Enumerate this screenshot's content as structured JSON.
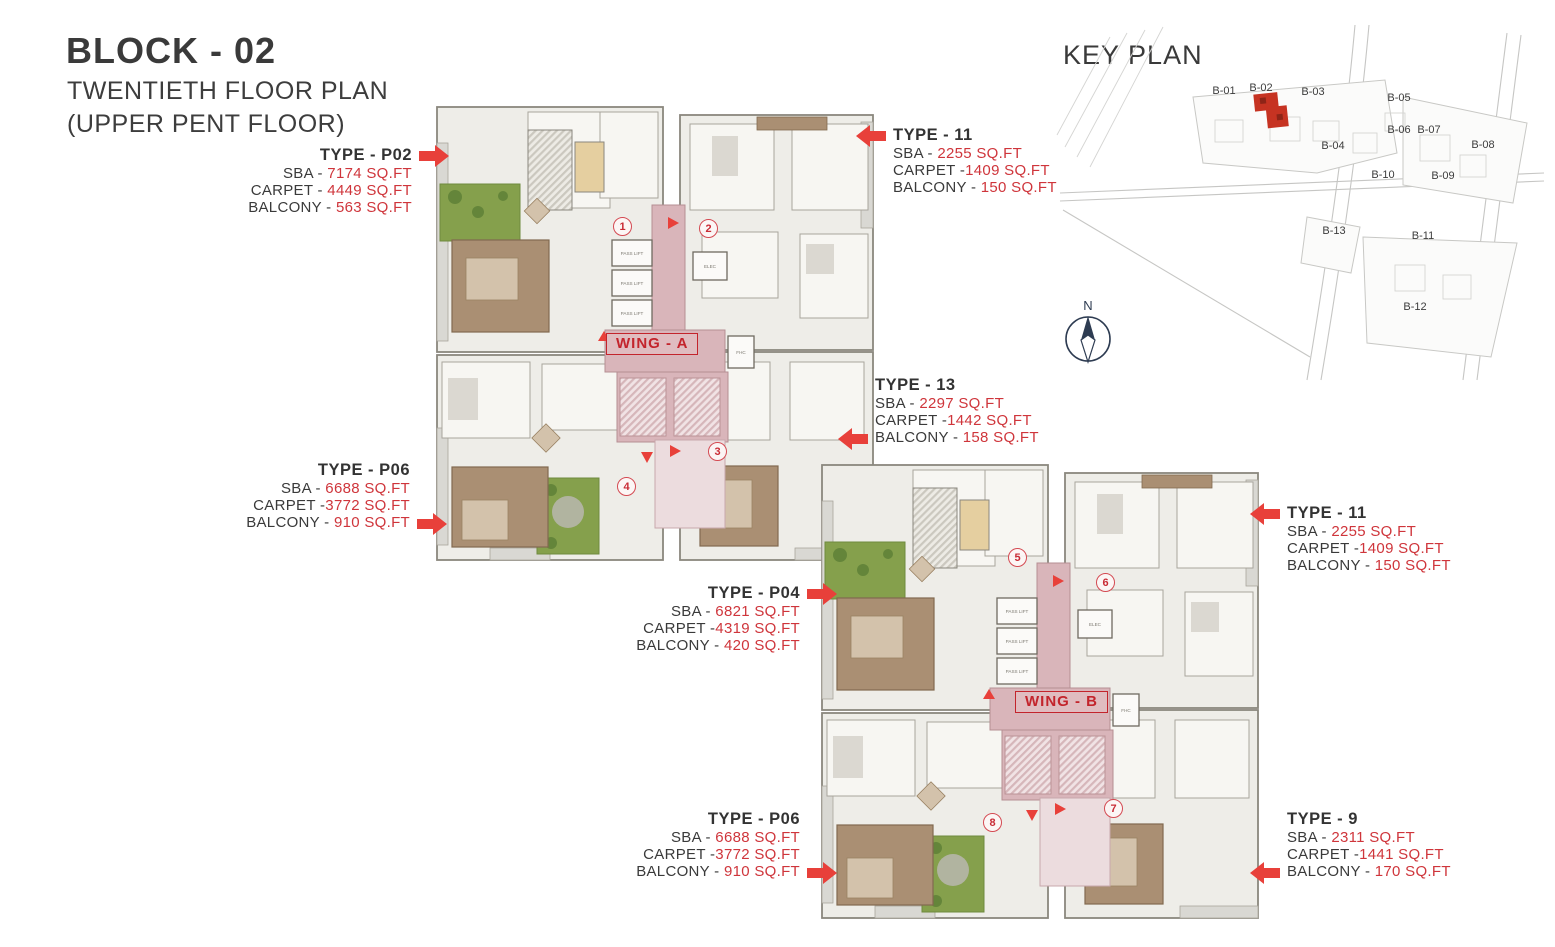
{
  "header": {
    "title": "BLOCK - 02",
    "subtitle_line1": "TWENTIETH FLOOR PLAN",
    "subtitle_line2": "(UPPER PENT FLOOR)"
  },
  "key_plan": {
    "title": "KEY PLAN",
    "compass_label": "N",
    "highlighted_block": "B-02",
    "blocks": [
      "B-01",
      "B-02",
      "B-03",
      "B-04",
      "B-05",
      "B-06",
      "B-07",
      "B-08",
      "B-09",
      "B-10",
      "B-11",
      "B-12",
      "B-13"
    ]
  },
  "wings": {
    "wing_a": "WING - A",
    "wing_b": "WING - B"
  },
  "plan_labels": {
    "pass_lift": "PASS LIFT",
    "elec": "ELEC",
    "fhc": "FHC"
  },
  "unit_markers": [
    "1",
    "2",
    "3",
    "4",
    "5",
    "6",
    "7",
    "8"
  ],
  "type_labels": [
    {
      "name": "TYPE - P02",
      "sba_l": "SBA - ",
      "sba_v": "7174 SQ.FT",
      "carpet_l": "CARPET - ",
      "carpet_v": "4449 SQ.FT",
      "balcony_l": "BALCONY - ",
      "balcony_v": "563 SQ.FT"
    },
    {
      "name": "TYPE - 11",
      "sba_l": "SBA - ",
      "sba_v": "2255 SQ.FT",
      "carpet_l": "CARPET -",
      "carpet_v": "1409 SQ.FT",
      "balcony_l": "BALCONY - ",
      "balcony_v": "150 SQ.FT"
    },
    {
      "name": "TYPE - 13",
      "sba_l": "SBA - ",
      "sba_v": "2297 SQ.FT",
      "carpet_l": "CARPET -",
      "carpet_v": "1442 SQ.FT",
      "balcony_l": "BALCONY - ",
      "balcony_v": "158 SQ.FT"
    },
    {
      "name": "TYPE - P06",
      "sba_l": "SBA - ",
      "sba_v": "6688 SQ.FT",
      "carpet_l": "CARPET -",
      "carpet_v": "3772 SQ.FT",
      "balcony_l": "BALCONY - ",
      "balcony_v": "910 SQ.FT"
    },
    {
      "name": "TYPE - P04",
      "sba_l": "SBA - ",
      "sba_v": "6821 SQ.FT",
      "carpet_l": "CARPET -",
      "carpet_v": "4319 SQ.FT",
      "balcony_l": "BALCONY - ",
      "balcony_v": "420 SQ.FT"
    },
    {
      "name": "TYPE - 11",
      "sba_l": "SBA - ",
      "sba_v": "2255 SQ.FT",
      "carpet_l": "CARPET -",
      "carpet_v": "1409 SQ.FT",
      "balcony_l": "BALCONY - ",
      "balcony_v": "150 SQ.FT"
    },
    {
      "name": "TYPE - P06",
      "sba_l": "SBA - ",
      "sba_v": "6688 SQ.FT",
      "carpet_l": "CARPET -",
      "carpet_v": "3772 SQ.FT",
      "balcony_l": "BALCONY - ",
      "balcony_v": "910 SQ.FT"
    },
    {
      "name": "TYPE - 9",
      "sba_l": "SBA - ",
      "sba_v": "2311 SQ.FT",
      "carpet_l": "CARPET -",
      "carpet_v": "1441 SQ.FT",
      "balcony_l": "BALCONY - ",
      "balcony_v": "170 SQ.FT"
    }
  ],
  "colors": {
    "accent_red": "#d2353c",
    "arrow_red": "#e8403a",
    "corridor_pink": "#d9b5ba",
    "terrace_green": "#85a04c",
    "room_brown": "#aa8f73",
    "keyplan_highlight": "#c63322"
  }
}
